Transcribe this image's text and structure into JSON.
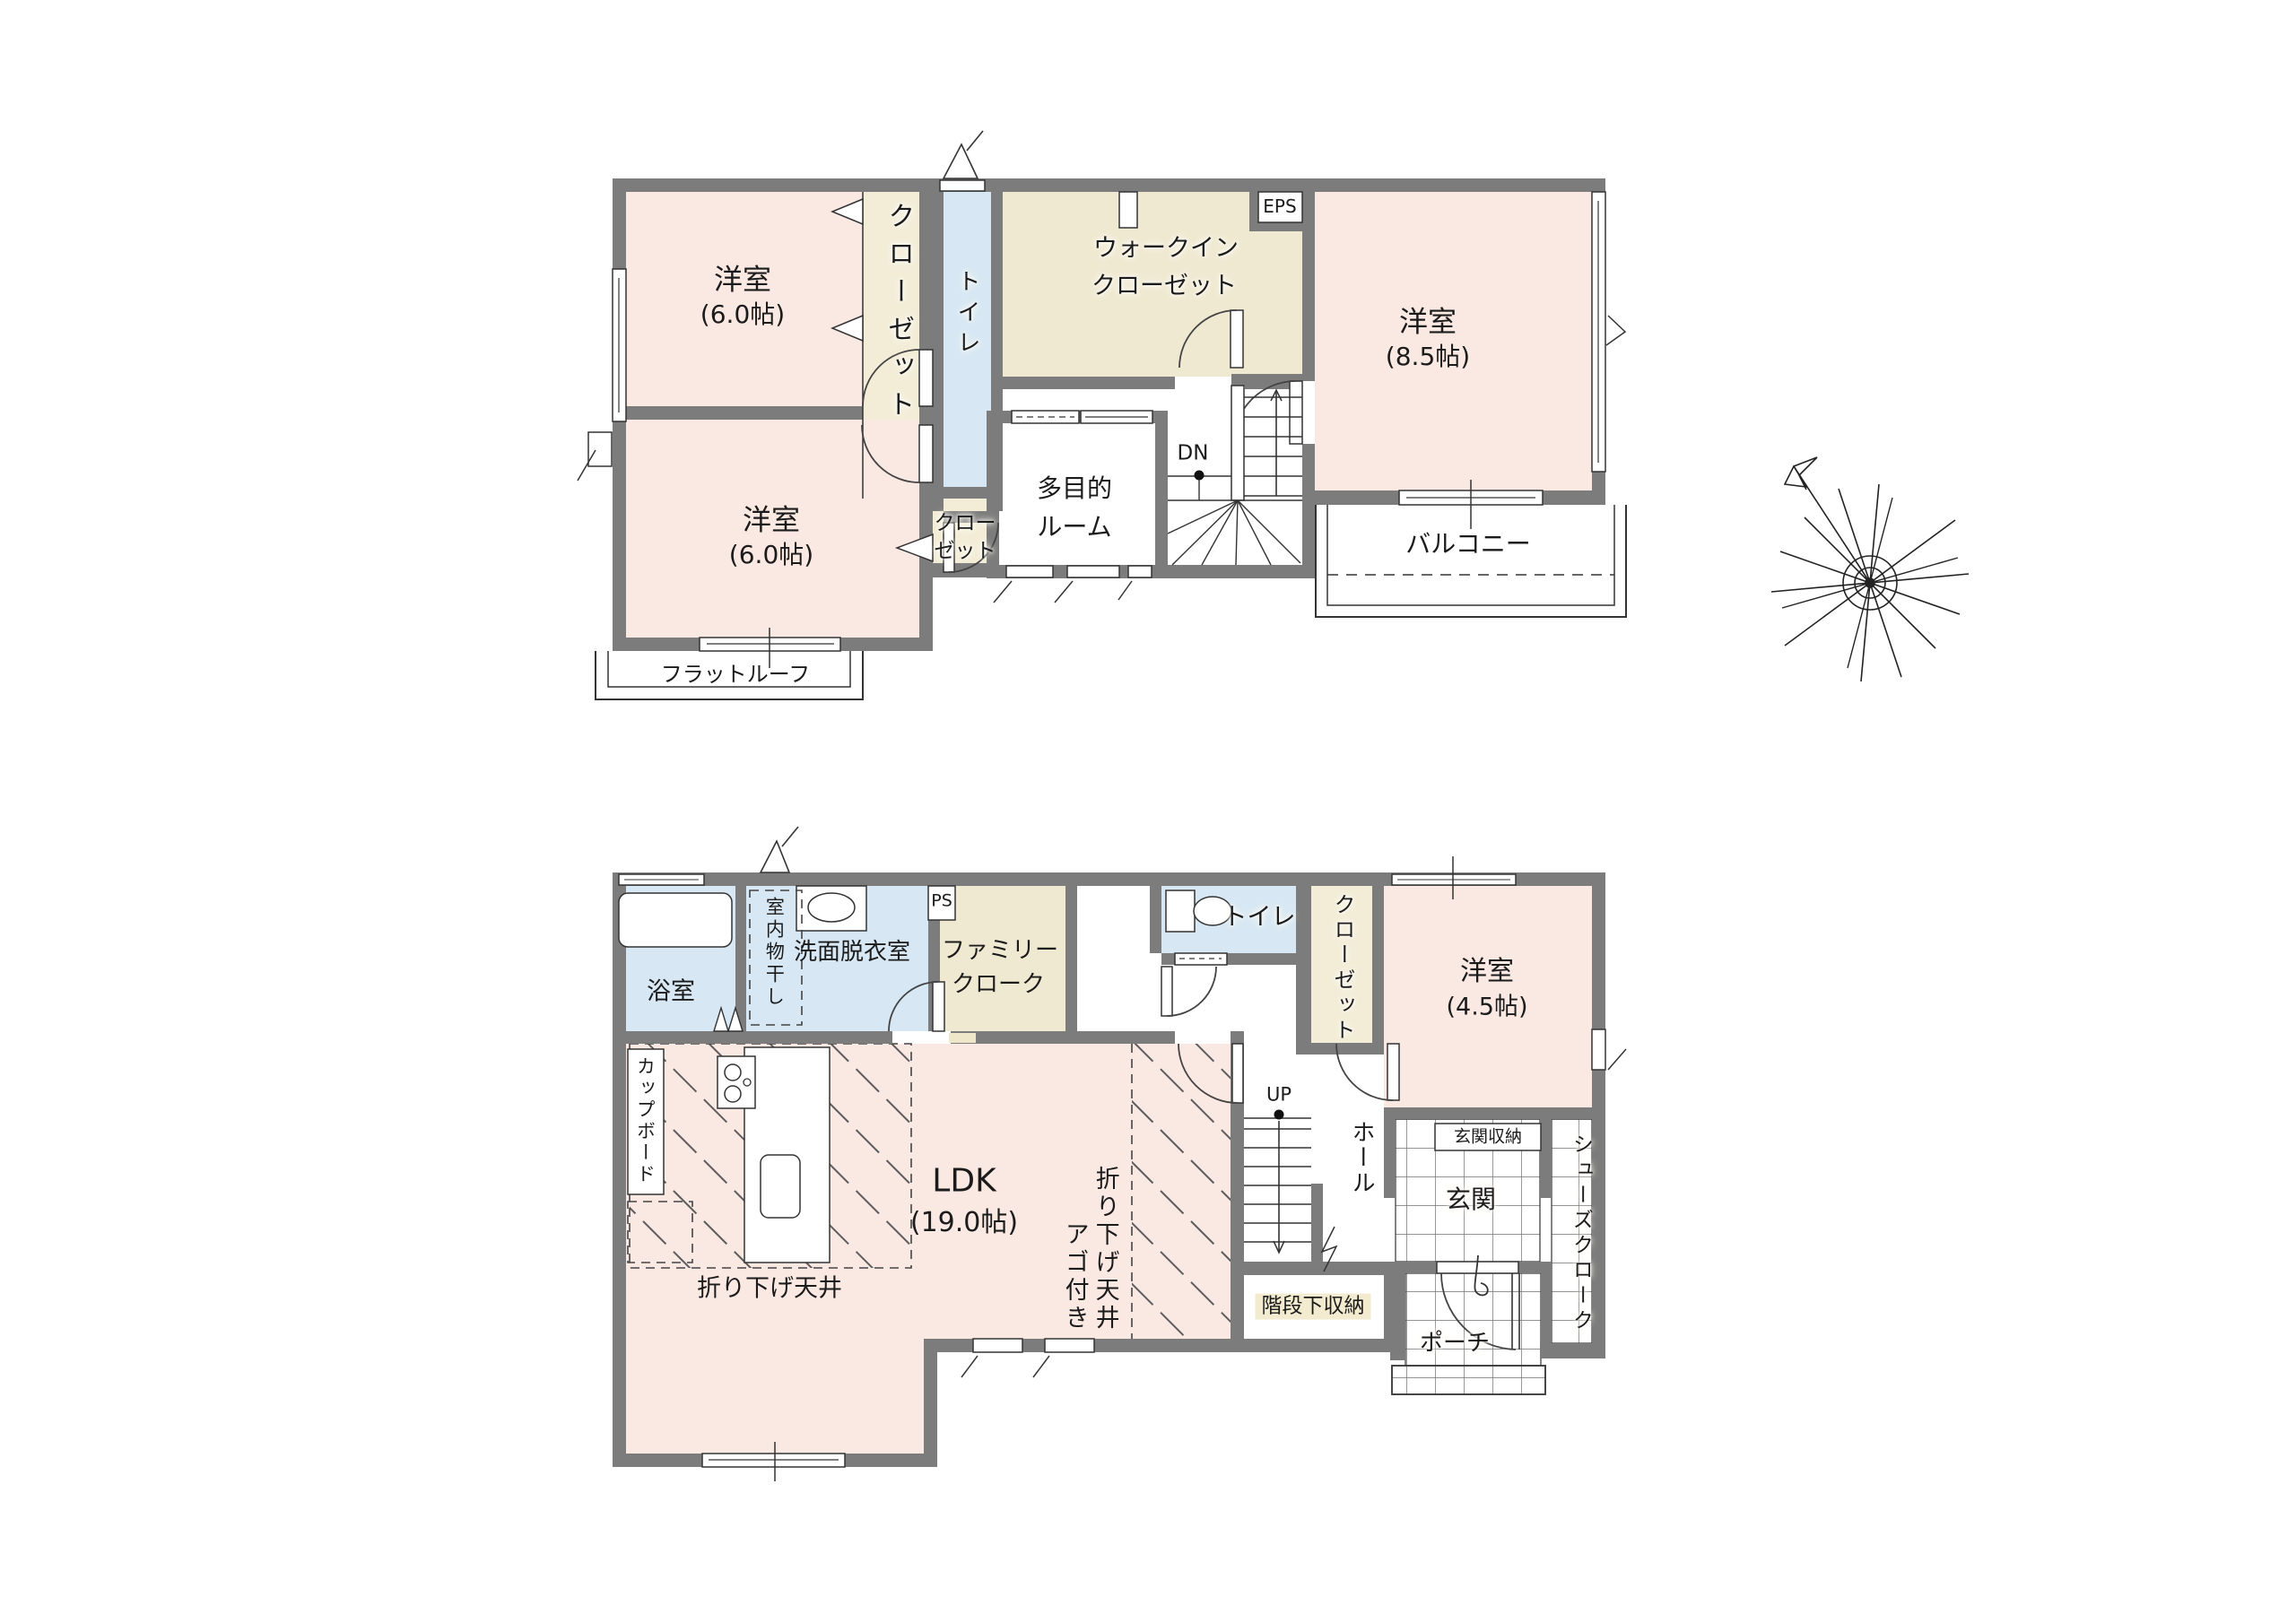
{
  "document_type": "floor-plan",
  "colors": {
    "wall": "#7c7c7c",
    "room_pink": "#fae8e2",
    "wet_blue": "#d7e8f4",
    "closet_cream": "#f3edd8",
    "storage_tan": "#f0e9d2",
    "line": "#333333"
  },
  "floor2": {
    "room1": {
      "name": "洋室",
      "size": "(6.0帖)"
    },
    "room2": {
      "name": "洋室",
      "size": "(6.0帖)"
    },
    "room3": {
      "name": "洋室",
      "size": "(8.5帖)"
    },
    "closet_top": "クローゼット",
    "toilet": "トイレ",
    "wic_line1": "ウォークイン",
    "wic_line2": "クローゼット",
    "eps": "EPS",
    "multi_line1": "多目的",
    "multi_line2": "ルーム",
    "dn": "DN",
    "closet2_line1": "クロー",
    "closet2_line2": "ゼット",
    "balcony": "バルコニー",
    "flat_roof": "フラットルーフ"
  },
  "floor1": {
    "bath": "浴室",
    "laundry": "室内物干し",
    "washroom": "洗面脱衣室",
    "ps": "PS",
    "family_line1": "ファミリー",
    "family_line2": "クローク",
    "toilet": "トイレ",
    "closet": "クローゼット",
    "room": {
      "name": "洋室",
      "size": "(4.5帖)"
    },
    "up": "UP",
    "hall": "ホール",
    "entrance_storage": "玄関収納",
    "entrance": "玄関",
    "shoe_closet": "シューズクローク",
    "under_stairs": "階段下収納",
    "porch": "ポーチ",
    "cupboard": "カップボード",
    "ldk": {
      "name": "LDK",
      "size": "(19.0帖)"
    },
    "lowered_ceiling": "折り下げ天井",
    "lowered_ceiling_ago_line1": "折り下げ天井",
    "lowered_ceiling_ago_line2": "アゴ付き"
  }
}
